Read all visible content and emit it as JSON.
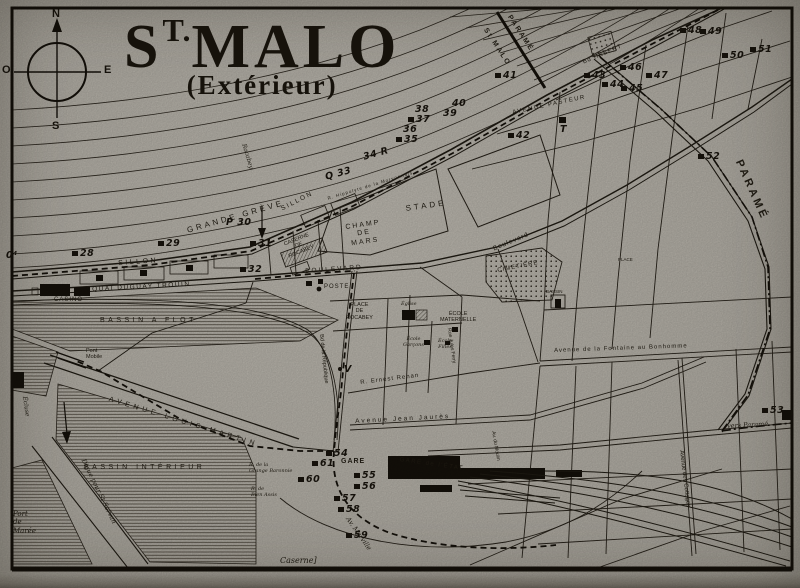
{
  "map_title": {
    "main_prefix": "S",
    "main_sup": "T.",
    "main_rest": "MALO",
    "subtitle": "(Extérieur)"
  },
  "compass": {
    "n": "N",
    "o": "O",
    "e": "E",
    "s": "S"
  },
  "colors": {
    "paper": "#b5b1a8",
    "ink": "#1c1810"
  },
  "labels": {
    "grande_greve": "GRANDE GRÈVE",
    "sillon_a": "SILLON",
    "sillon_b": "SILLON",
    "rocabey_beach": "Rocabey",
    "quai_duguay": "QUAI DUGUAY TROUIN",
    "casino": "CASINO",
    "bassin_flot": "BASSIN A FLOT",
    "bassin_int": "BASSIN INTÉRIEUR",
    "av_louis_martin": "AVENUE  LOUIS  MARTIN",
    "digue": "Digue pour St Servan",
    "port_maree": "Port\nde\nMarée",
    "pont_mobile": "Pont\nMobile",
    "ecluse": "Écluse",
    "champ_de_mars": "CHAMP\nDE\nMARS",
    "stade": "STADE",
    "caserne_rocabey": "CASERNE\nDE\nROCABEY",
    "boulevard_c": "BOULEVARD",
    "boulevard_r": "Boulevard",
    "poste": "POSTE",
    "place_rocabey": "PLACE\nDE\nROCABEY",
    "cimetiere": "CIMETIÈRE",
    "eglise": "Église",
    "ecole_maternelle": "ÉCOLE\nMATERNELLE",
    "ecole_garcons": "École\nGarçons",
    "ecole_filles": "École\nFilles",
    "ernest_renan": "R. Ernest Renan",
    "jean_jaures": "Avenue Jean Jaurès",
    "fontaine": "Avenue de la Fontaine au Bonhomme",
    "bassin_small": "BASSIN",
    "vers_parame": "vers Paramé",
    "cottages": "Avenue des Cottages",
    "moulin": "Av. du Moulin",
    "jules_ferry": "Rue Jules Ferry",
    "marville": "Av. Marville",
    "caserne_bottom": "Caserne]",
    "gare": "GARE",
    "gare_etat": "GARE de l'ÉTAT",
    "grange_baronnie": "R. de la\nGrange Baronnie",
    "bien_assis": "R. de\nBien Assis",
    "pasteur": "AVENUE PASTEUR",
    "hebert": "Bd HÉBERT",
    "morvonnais": "R. Hippolyte de la Morvonnais",
    "republique": "Bd de la République",
    "parame_big": "PARAMÉ",
    "parame_border": "PARAMÉ",
    "stmalo_border": "St MALO",
    "place_small": "PLACE"
  },
  "markers": [
    {
      "t": "0⁴"
    },
    {
      "t": "28"
    },
    {
      "t": "29"
    },
    {
      "t": "P 30"
    },
    {
      "t": "31"
    },
    {
      "t": "32"
    },
    {
      "t": "Q 33"
    },
    {
      "t": "34 R"
    },
    {
      "t": "35"
    },
    {
      "t": "36"
    },
    {
      "t": "37"
    },
    {
      "t": "38"
    },
    {
      "t": "39"
    },
    {
      "t": "40"
    },
    {
      "t": "41"
    },
    {
      "t": "42"
    },
    {
      "t": "43"
    },
    {
      "t": "44"
    },
    {
      "t": "45"
    },
    {
      "t": "46"
    },
    {
      "t": "47"
    },
    {
      "t": "48"
    },
    {
      "t": "49"
    },
    {
      "t": "50"
    },
    {
      "t": "51"
    },
    {
      "t": "52"
    },
    {
      "t": "53"
    },
    {
      "t": "54"
    },
    {
      "t": "55"
    },
    {
      "t": "56"
    },
    {
      "t": "57"
    },
    {
      "t": "58"
    },
    {
      "t": "59"
    },
    {
      "t": "60"
    },
    {
      "t": "61"
    },
    {
      "t": "T"
    },
    {
      "t": "V"
    }
  ]
}
